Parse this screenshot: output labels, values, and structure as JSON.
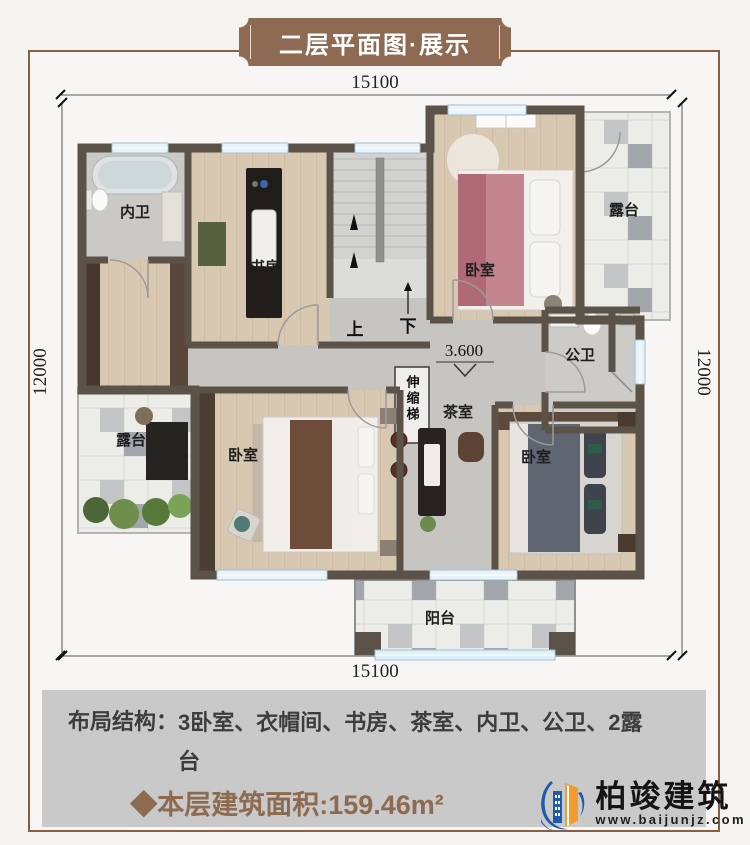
{
  "banner": {
    "title": "二层平面图·展示"
  },
  "dimensions": {
    "top": "15100",
    "bottom": "15100",
    "left": "12000",
    "right": "12000"
  },
  "floorplan": {
    "elevation": "3.600",
    "stairs": {
      "up": "上",
      "down": "下"
    },
    "ladder_label": "伸缩梯",
    "rooms": [
      {
        "id": "ensuite-bath",
        "label": "内卫"
      },
      {
        "id": "study",
        "label": "书房"
      },
      {
        "id": "bedroom-top",
        "label": "卧室"
      },
      {
        "id": "terrace-right",
        "label": "露台"
      },
      {
        "id": "public-bath",
        "label": "公卫"
      },
      {
        "id": "terrace-left",
        "label": "露台"
      },
      {
        "id": "bedroom-left",
        "label": "卧室"
      },
      {
        "id": "tea-room",
        "label": "茶室"
      },
      {
        "id": "bedroom-right",
        "label": "卧室"
      },
      {
        "id": "balcony",
        "label": "阳台"
      }
    ]
  },
  "footer": {
    "layout_label": "布局结构：",
    "layout_value": "3卧室、衣帽间、书房、茶室、内卫、公卫、2露台",
    "area_text": "◆本层建筑面积:159.46m²"
  },
  "logo": {
    "name": "柏竣建筑",
    "website": "www.baijunjz.com"
  },
  "colors": {
    "accent_brown": "#8d6a51",
    "frame_brown": "#8a5f3f",
    "wall": "#5b5348",
    "footer_bg": "#c9c9c9",
    "area_text_brown": "#8c6b50",
    "logo_blue": "#1c5caa",
    "logo_orange": "#f39c2d"
  }
}
